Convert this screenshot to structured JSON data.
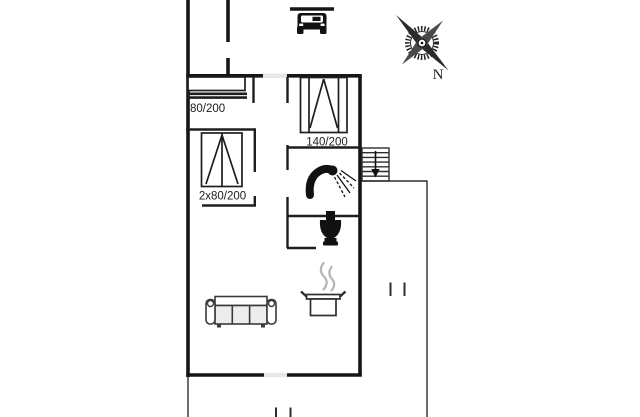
{
  "page": {
    "type": "holiday-home floor plan",
    "background": "#ffffff"
  },
  "labels": {
    "bed_single": "80/200",
    "bed_double": "2x80/200",
    "bed_140": "140/200",
    "compass_north": "N"
  },
  "colors": {
    "wall": "#161616",
    "interior-wall": "#1e1e1e",
    "thin-line": "#2e2e2e",
    "door-gap": "#e7e7e7",
    "furniture": "#3a3a3a",
    "cushion": "#ededed",
    "steam": "#b5b5b5",
    "icon": "#111111",
    "label-text": "#1c1c1c"
  },
  "icons": {
    "car-icon": "car front view under carport roof line",
    "compass-rose-icon": "compass rose, N toward lower right",
    "single-bed-icon": "single bed 80/200 along wall",
    "double-bed-icon": "double bed 2x80/200 with duvet fold",
    "bed-140-icon": "bed 140/200 with duvet fold",
    "shower-icon": "shower head with spray",
    "toilet-icon": "toilet silhouette",
    "cooking-pot-icon": "steaming pot (kitchen)",
    "sofa-icon": "three-seat sofa",
    "stairs-icon": "exterior stairs with down arrow"
  }
}
